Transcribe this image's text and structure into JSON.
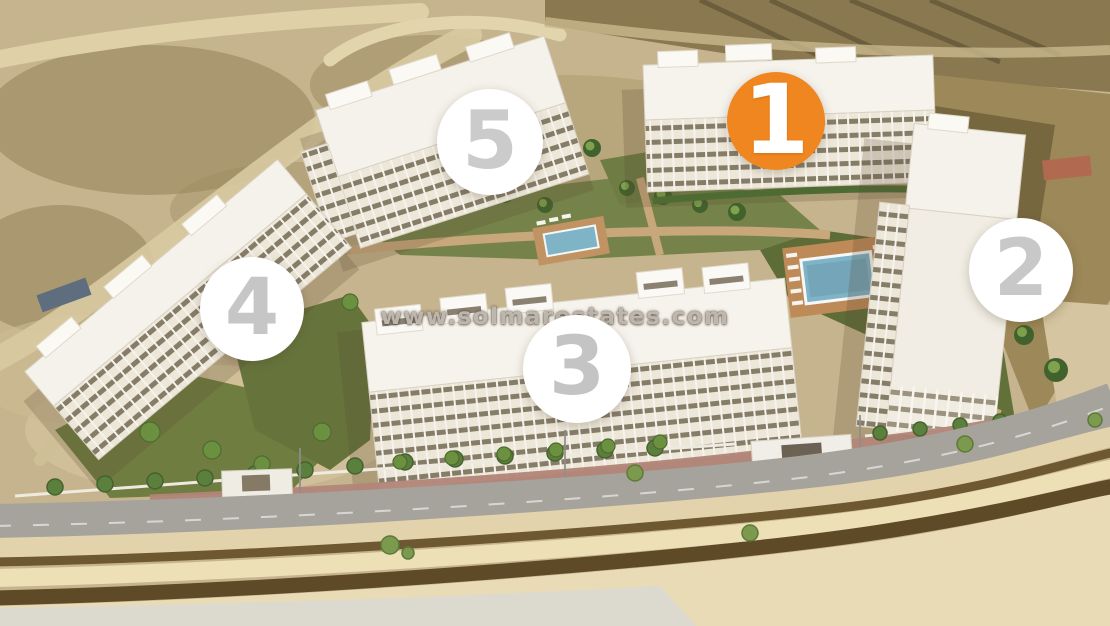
{
  "image": {
    "watermark": "www.solmarestates.com"
  },
  "colors": {
    "accent_orange": "#F0861F",
    "marker_bg_white": "#FFFFFF",
    "marker_number_gray": "#C6C6C6"
  },
  "markers": [
    {
      "name": "block-1",
      "label": "1",
      "x": 776,
      "y": 121,
      "r": 49,
      "bg": "#F0861F",
      "fg": "#FFFFFF",
      "highlighted": true
    },
    {
      "name": "block-2",
      "label": "2",
      "x": 1021,
      "y": 270,
      "r": 52,
      "bg": "#FFFFFF",
      "fg": "#C8C8C8",
      "highlighted": false
    },
    {
      "name": "block-3",
      "label": "3",
      "x": 577,
      "y": 369,
      "r": 54,
      "bg": "#FFFFFF",
      "fg": "#C4C4C4",
      "highlighted": false
    },
    {
      "name": "block-4",
      "label": "4",
      "x": 252,
      "y": 309,
      "r": 52,
      "bg": "#FFFFFF",
      "fg": "#C6C6C6",
      "highlighted": false
    },
    {
      "name": "block-5",
      "label": "5",
      "x": 490,
      "y": 142,
      "r": 53,
      "bg": "#FFFFFF",
      "fg": "#CBCBCB",
      "highlighted": false
    }
  ]
}
